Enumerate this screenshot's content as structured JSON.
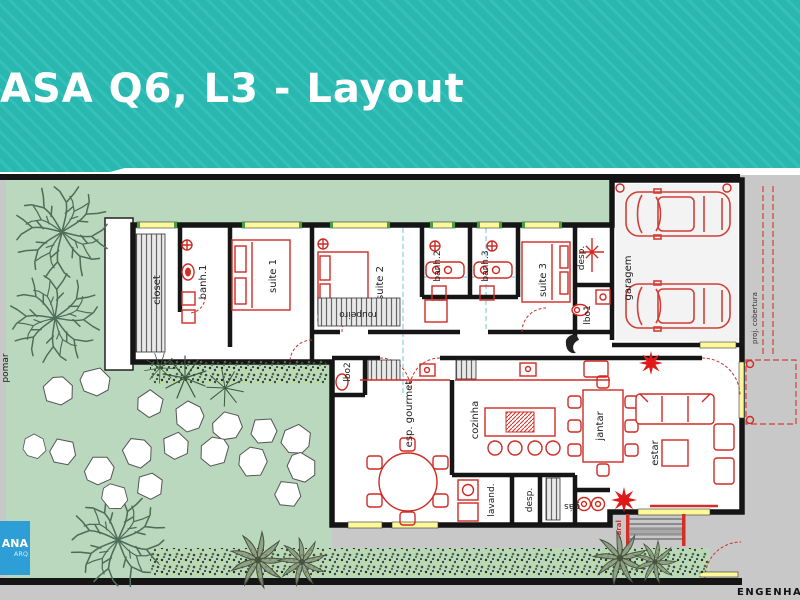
{
  "slide": {
    "title": "ASA Q6, L3 - Layout",
    "footer_brand": "ENGENHARIA"
  },
  "logo": {
    "line1": "ANA",
    "line2": "ARQ"
  },
  "plan": {
    "labels": {
      "closet": "closet",
      "banh1": "banh.1",
      "suite1": "suite 1",
      "suite2": "suite 2",
      "banh2": "banh.2",
      "banh3": "banh.3",
      "suite3": "suite 3",
      "desp_top": "desp.",
      "lbo1": "lbo1",
      "garagem": "garagem",
      "roupeiro": "roupeiro",
      "lbo2": "lbo2",
      "esp_gourmet": "esp. gourmet",
      "cozinha": "cozinha",
      "lavand": "lavand.",
      "desp_bottom": "desp.",
      "jantar": "jantar",
      "estar": "estar",
      "gas": "gás",
      "varal": "varal",
      "pomar": "pomar",
      "proj_cobertura": "proj. cobertura"
    },
    "colors": {
      "banner": "#2ab7b0",
      "banner_stripe": "#35c0b9",
      "lawn": "#b9d8bd",
      "surround": "#c8c8c8",
      "wall": "#151515",
      "furniture": "#cf2b24",
      "window_sill": "#fdf89a",
      "window_cap": "#46a046",
      "guide_line": "#62c9e6",
      "logo_bg": "#2e9ed7",
      "title_text": "#ffffff"
    }
  }
}
